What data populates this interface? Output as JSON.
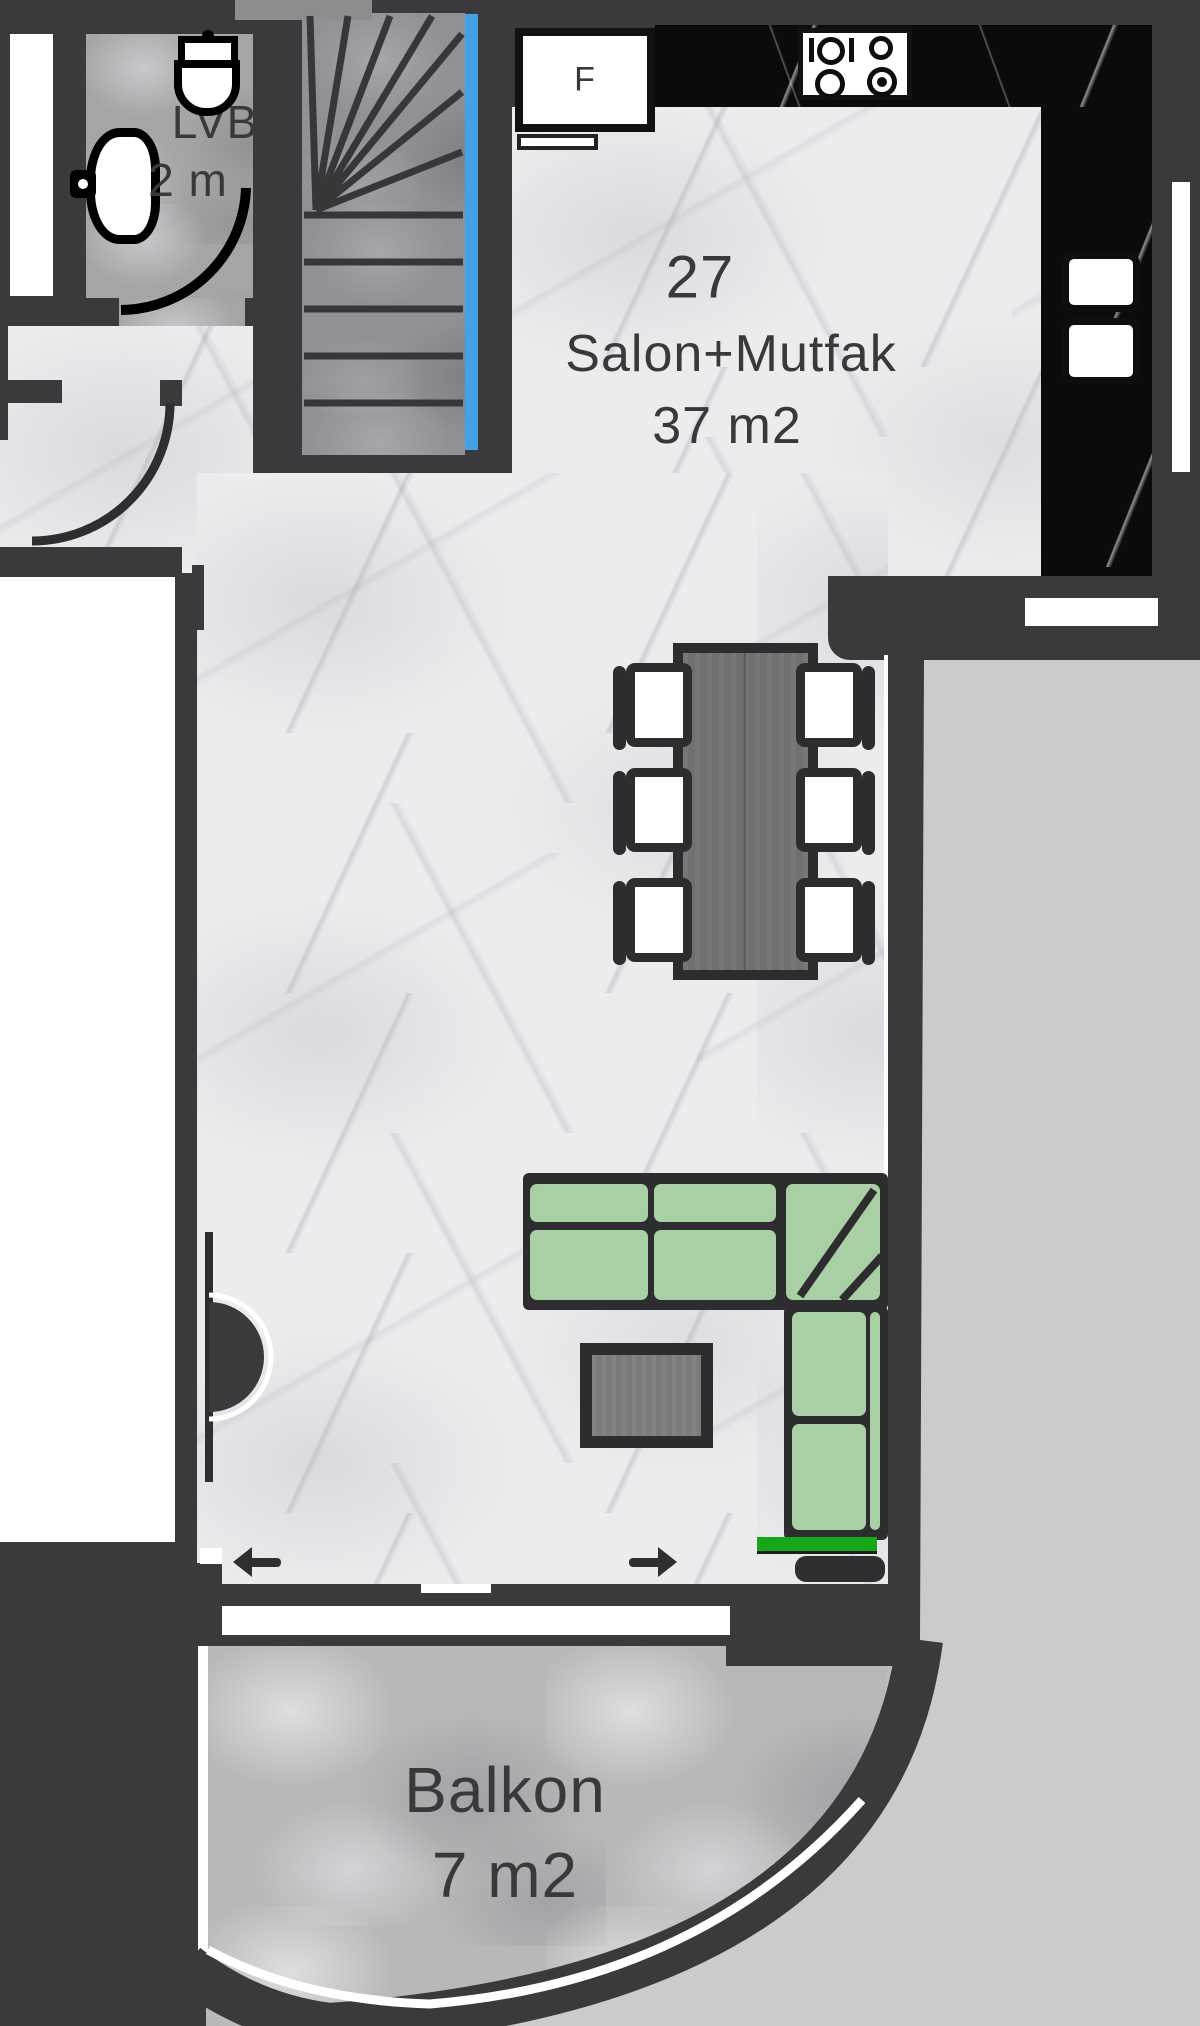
{
  "labels": {
    "unit_number": "27",
    "room_name": "Salon+Mutfak",
    "room_area": "37 m2",
    "balcony_name": "Balkon",
    "balcony_area": "7 m2",
    "wc_name": "LVB",
    "wc_area": "2 m",
    "fridge": "F"
  },
  "colors": {
    "wall": "#3a3a3c",
    "floor_marble": "#ececee",
    "wc_floor": "#a6a4a6",
    "stairs_floor": "#929094",
    "balcony_floor": "#b8b7b9",
    "counter_marble": "#0b0b0b",
    "stairs_glass_blue": "#45a1e6",
    "outside_area": "#cbcbcd",
    "sofa_green": "#a9d0a5",
    "accent_green": "#15a718",
    "text": "#39393b"
  },
  "furniture": [
    "winder-stairs",
    "fridge",
    "stove",
    "kitchen-sink",
    "dining-table",
    "dining-chairs",
    "l-shaped-sofa",
    "coffee-table",
    "toilet",
    "wash-basin",
    "radiator",
    "balcony-sliding-door"
  ]
}
